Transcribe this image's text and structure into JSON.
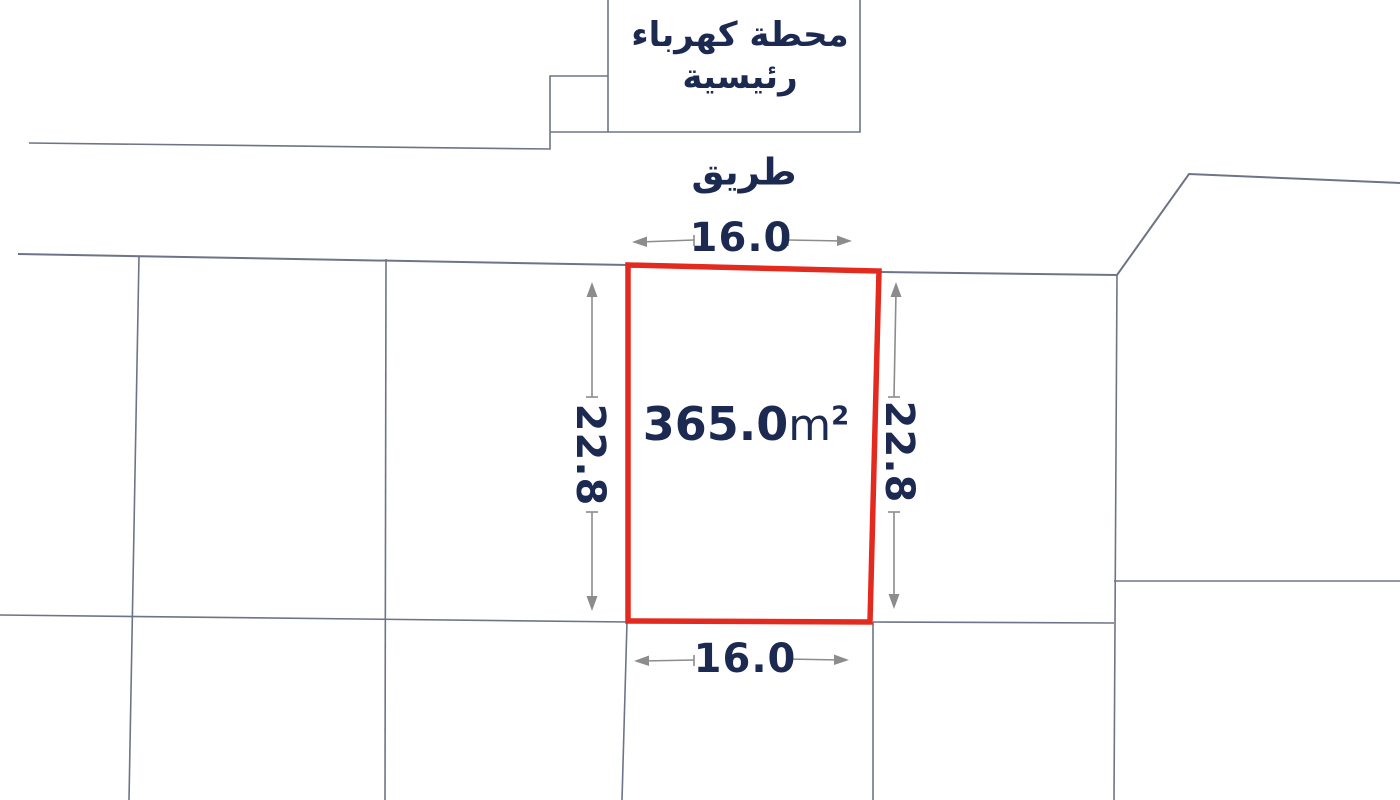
{
  "colors": {
    "navy": "#1c2951",
    "red": "#e4291f",
    "line": "#6e7487",
    "dim": "#8c8c8c",
    "bg": "#ffffff"
  },
  "labels": {
    "station_line1": "محطة كهرباء",
    "station_line2": "رئيسية",
    "road": "طريق"
  },
  "parcel": {
    "area_value": "365.0",
    "area_unit": "m",
    "area_sup": "2",
    "width_top": "16.0",
    "width_bottom": "16.0",
    "depth_left": "22.8",
    "depth_right": "22.8"
  }
}
